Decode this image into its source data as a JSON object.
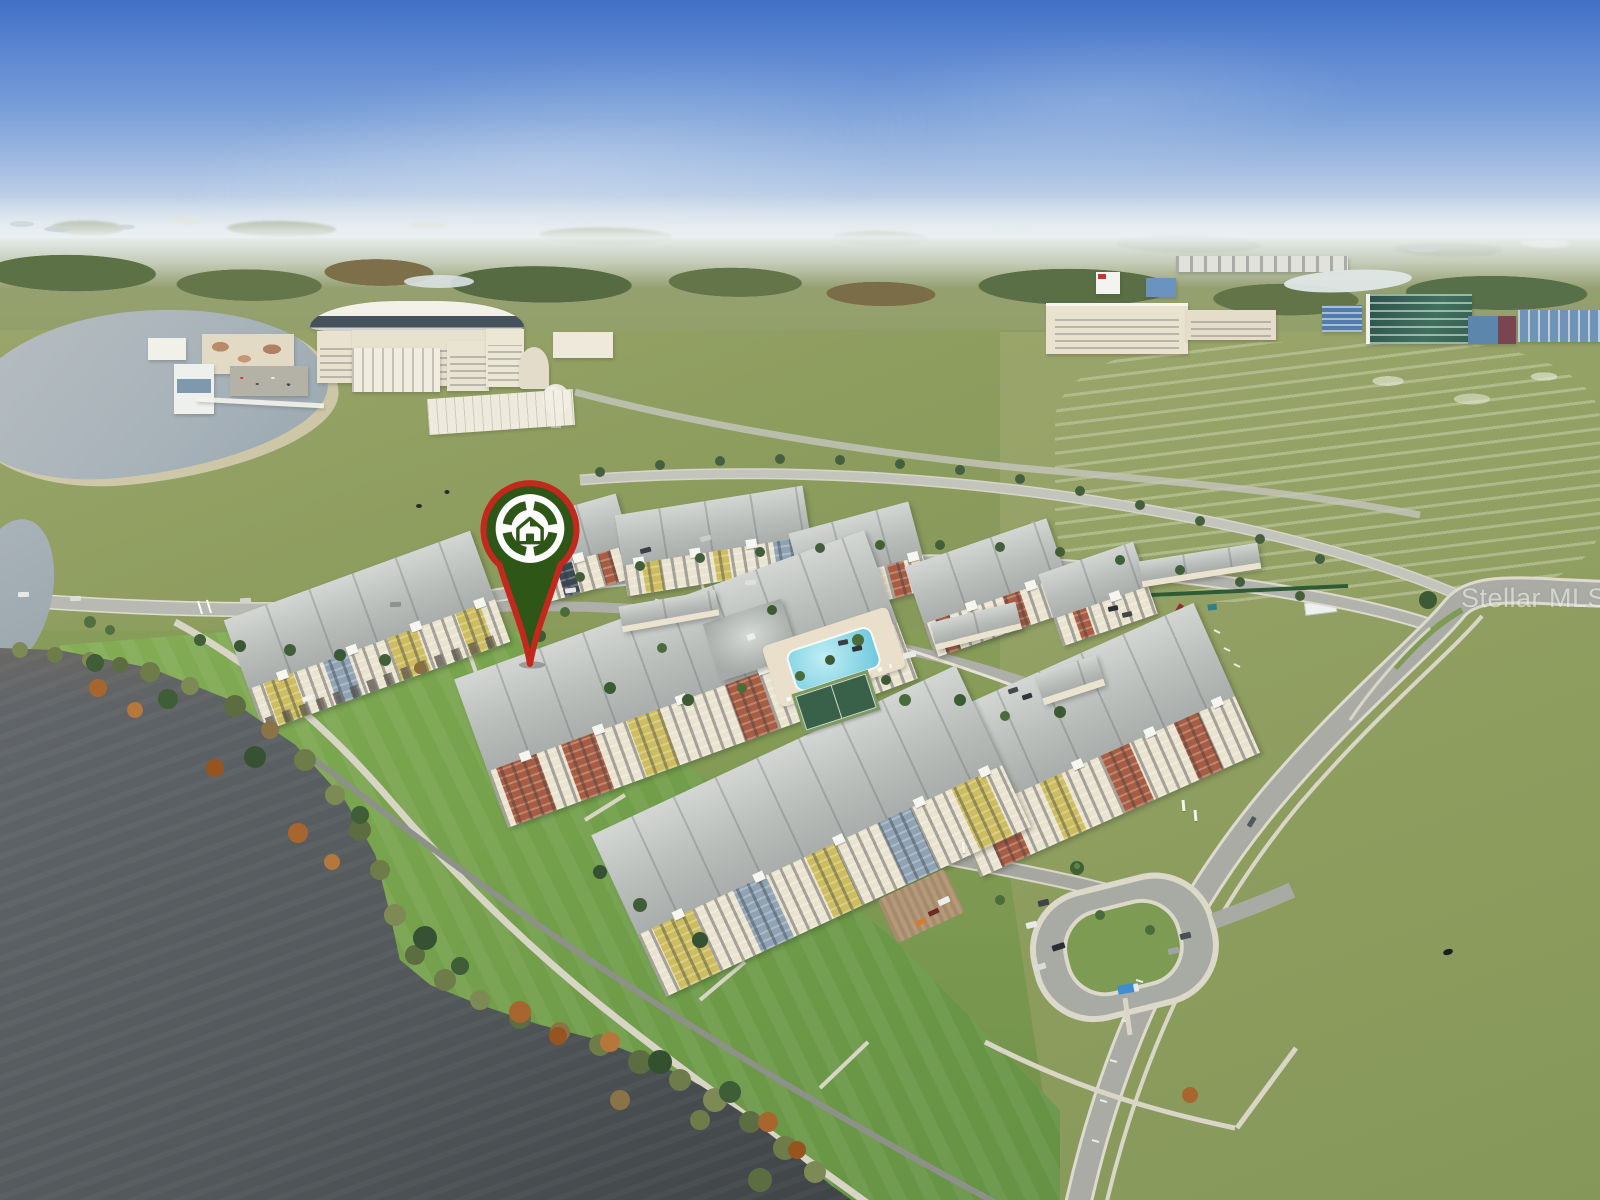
{
  "scene": {
    "subject": "aerial-drone-photo-of-lakefront-apartment-community",
    "elements": [
      "sky",
      "distant-tree-line",
      "campus-buildings",
      "glass-office-buildings",
      "grass-fields",
      "upper-lake",
      "lower-lake",
      "apartment-buildings",
      "swimming-pool",
      "tennis-court",
      "clubhouse",
      "garages",
      "construction-site",
      "tree-lined-boulevard",
      "curving-road",
      "cul-de-sac-parking-loop",
      "walking-trails",
      "parked-cars",
      "blue-box-truck",
      "cow-in-field",
      "autumn-trees"
    ]
  },
  "watermark": {
    "text": "Stellar MLS"
  },
  "marker": {
    "name": "property-location-pin",
    "icon": "house-aperture-logo"
  },
  "colors": {
    "sky_top": "#4170c5",
    "sky_mid": "#7ea2d9",
    "sky_horizon": "#e7edf0",
    "field": "#93a065",
    "lawn": "#79a24d",
    "water_upper": "#a7b2b9",
    "water_lower": "#53585b",
    "road": "#a9aba4",
    "concrete": "#d9d6c8",
    "roof": "#b9bdba",
    "facade_cream": "#eae3d0",
    "accent_rust": "#a85c42",
    "accent_yellow": "#cdbd5f",
    "accent_slate": "#8fa3b5",
    "accent_navy": "#3c4754",
    "campus_cream": "#e9e2cf",
    "glass_green": "#35604f",
    "glass_blue": "#5d86ad",
    "pool": "#6cc7dc",
    "tennis_court": "#396049",
    "pin_green": "#2d5617",
    "pin_red": "#c3281c",
    "truck_blue": "#3f8ed2",
    "autumn_tree": "#a8662f",
    "tree_green": "#3f5d36",
    "construction_tan": "#c9b892"
  }
}
